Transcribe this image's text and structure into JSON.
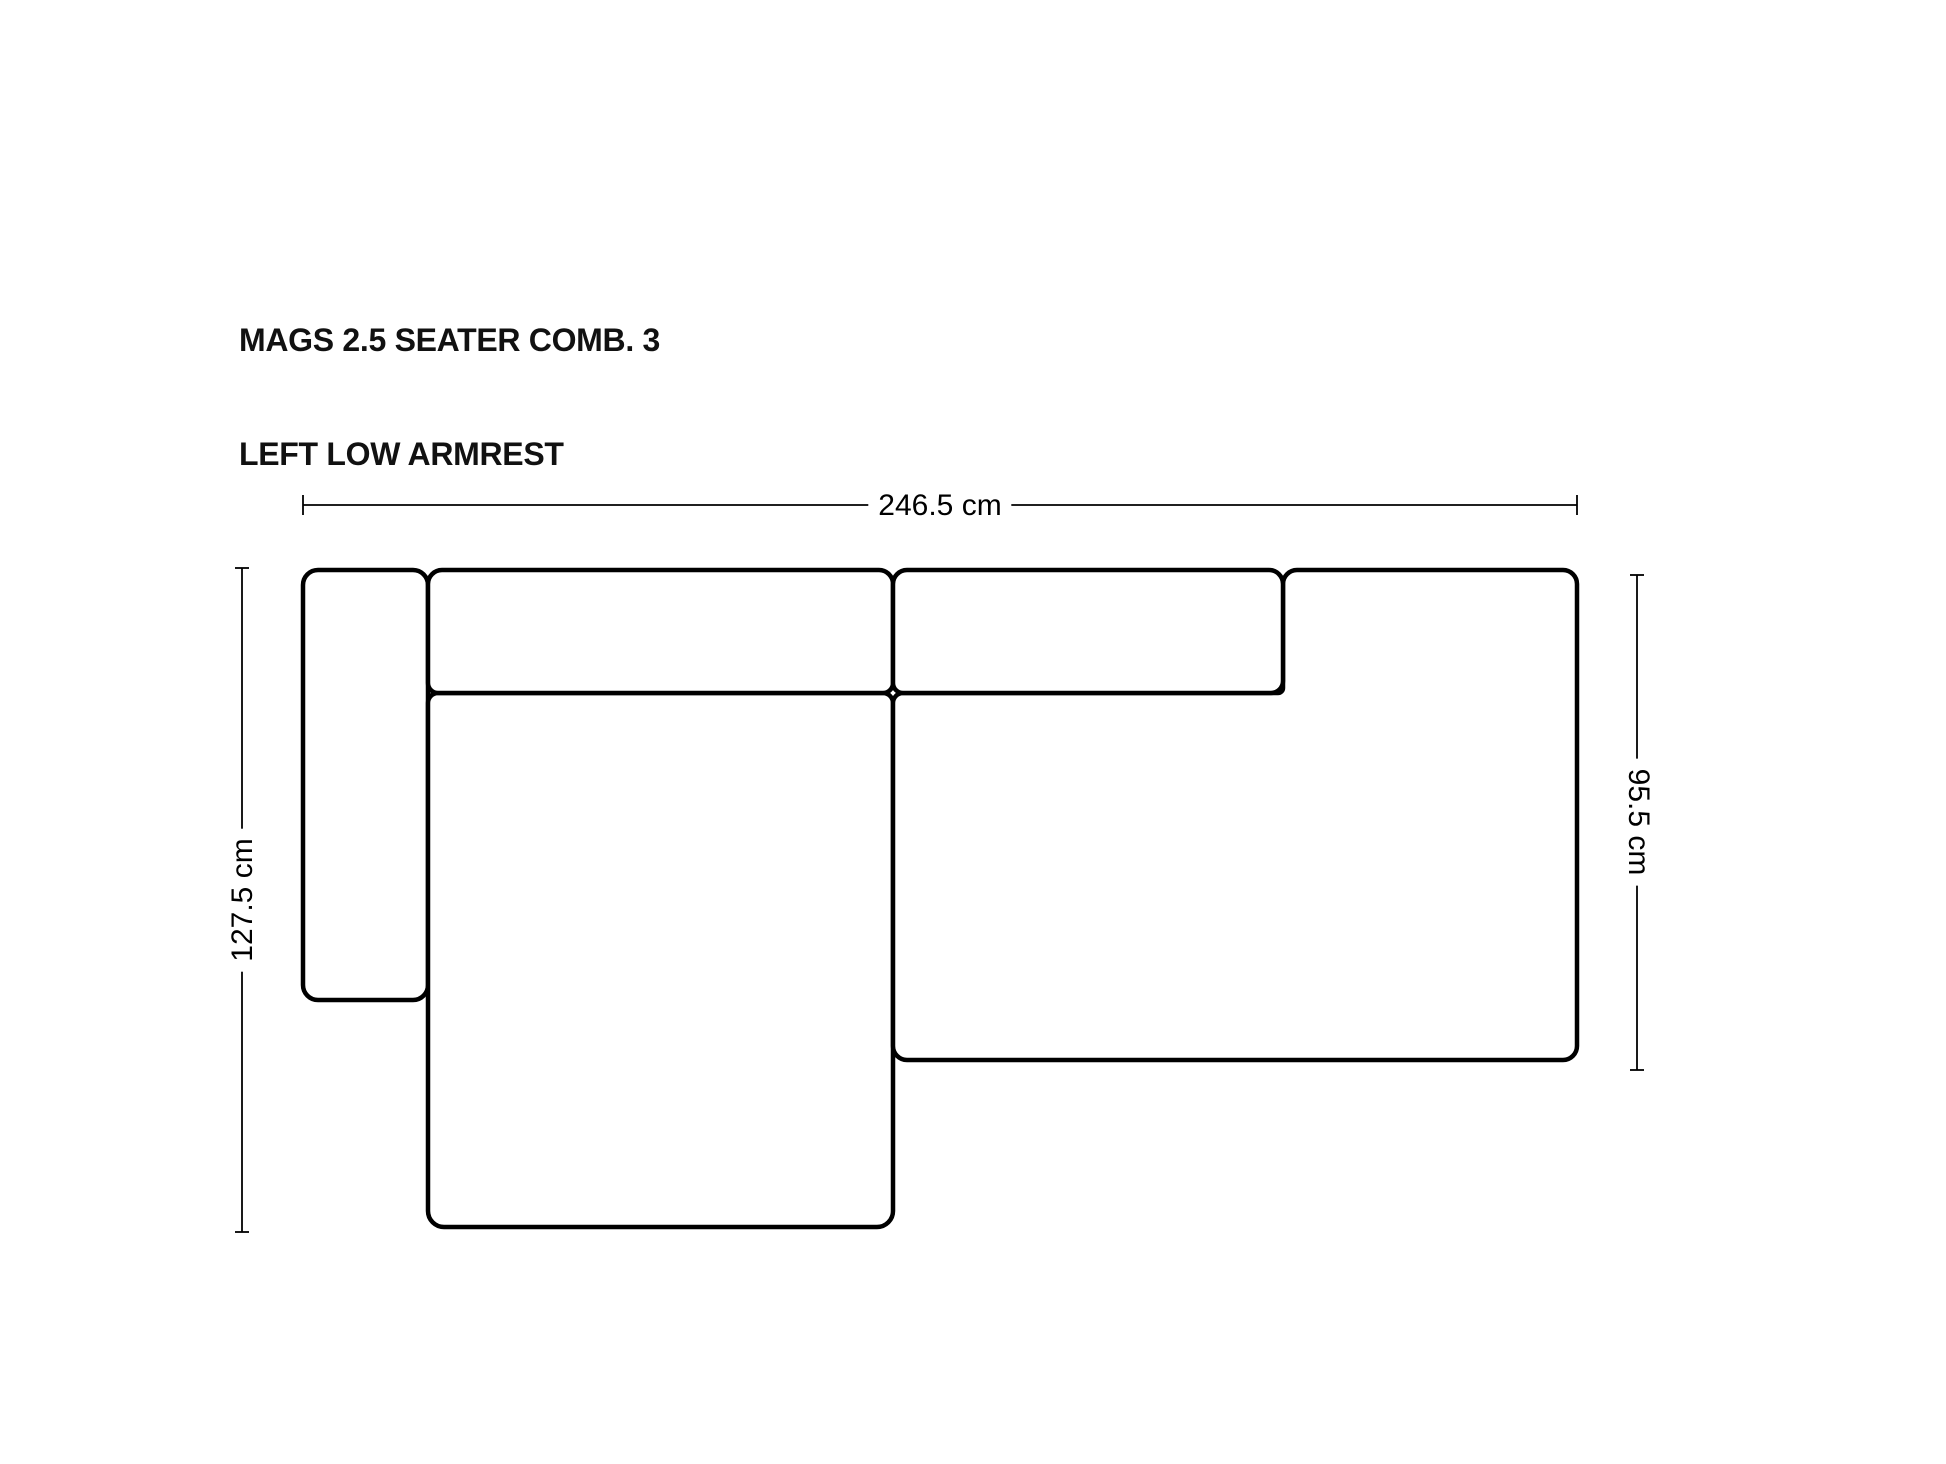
{
  "page": {
    "background": "#ffffff",
    "ink": "#000000"
  },
  "title": {
    "line1": "MAGS 2.5 SEATER COMB. 3",
    "line2": "LEFT LOW ARMREST"
  },
  "dimensions": {
    "overall_width": {
      "value": 246.5,
      "unit": "cm",
      "label": "246.5 cm"
    },
    "left_depth": {
      "value": 127.5,
      "unit": "cm",
      "label": "127.5 cm"
    },
    "right_depth": {
      "value": 95.5,
      "unit": "cm",
      "label": "95.5 cm"
    }
  },
  "diagram": {
    "kind": "top-view furniture dimension drawing",
    "pieces": [
      "left low armrest",
      "left backrest cushion",
      "right backrest cushion",
      "chaise seat",
      "right seat section"
    ]
  }
}
